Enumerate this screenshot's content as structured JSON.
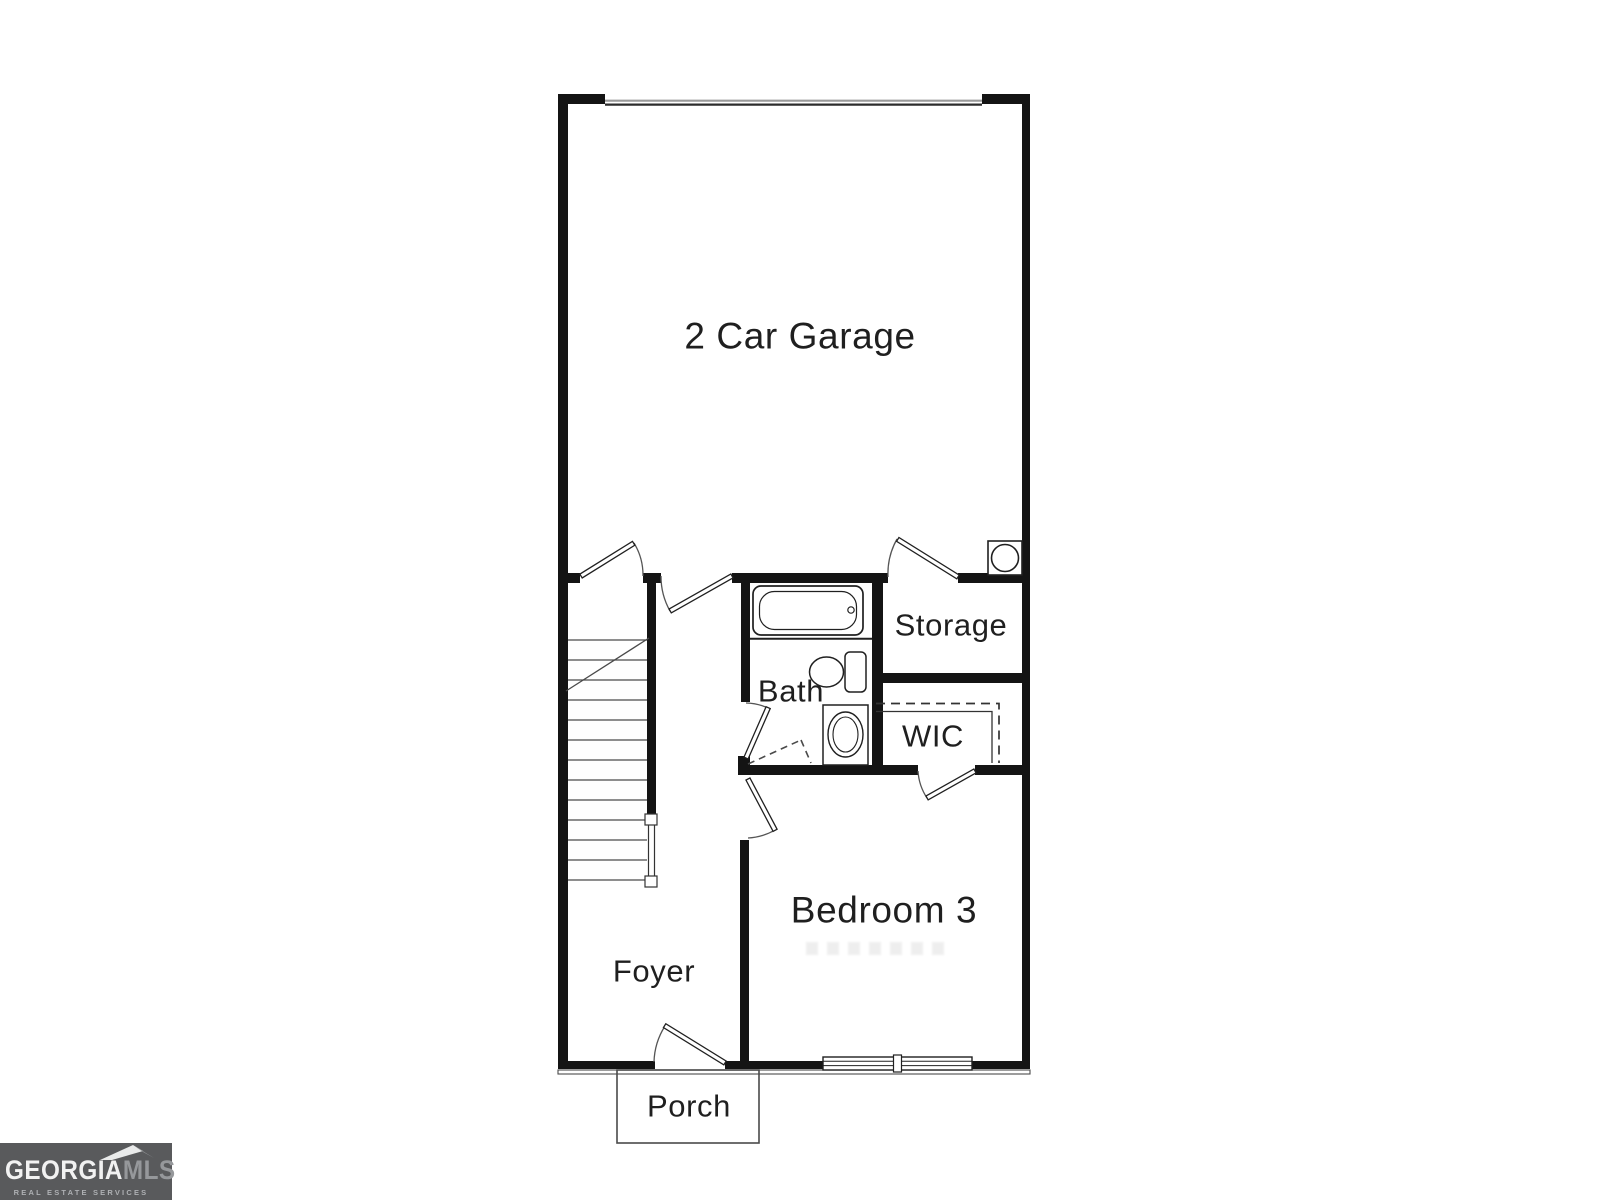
{
  "floorplan": {
    "rooms": [
      {
        "key": "garage",
        "label": "2 Car Garage"
      },
      {
        "key": "storage",
        "label": "Storage"
      },
      {
        "key": "bath",
        "label": "Bath"
      },
      {
        "key": "wic",
        "label": "WIC"
      },
      {
        "key": "bedroom3",
        "label": "Bedroom 3"
      },
      {
        "key": "foyer",
        "label": "Foyer"
      },
      {
        "key": "porch",
        "label": "Porch"
      }
    ],
    "fixtures": [
      {
        "icon": "garage-door-icon"
      },
      {
        "icon": "staircase-icon"
      },
      {
        "icon": "stair-railing-icon"
      },
      {
        "icon": "door-swing-icon"
      },
      {
        "icon": "bathtub-icon"
      },
      {
        "icon": "toilet-icon"
      },
      {
        "icon": "sink-icon"
      },
      {
        "icon": "water-heater-icon"
      },
      {
        "icon": "closet-shelf-rod-icon"
      },
      {
        "icon": "window-icon"
      }
    ],
    "colors": {
      "wall": "#141414",
      "fixture_line": "#202020",
      "light_line": "#4a4a4a",
      "label_text": "#1f1f1f",
      "background": "#ffffff"
    }
  },
  "logo": {
    "brand_primary": "GEORGIA",
    "brand_secondary": "MLS",
    "tagline": "REAL ESTATE SERVICES",
    "colors": {
      "background": "#595a5c",
      "primary_text": "#f2f2f2",
      "secondary_text": "#96989b",
      "roof_light": "#e9eaea",
      "roof_dark": "#8f9194"
    }
  }
}
